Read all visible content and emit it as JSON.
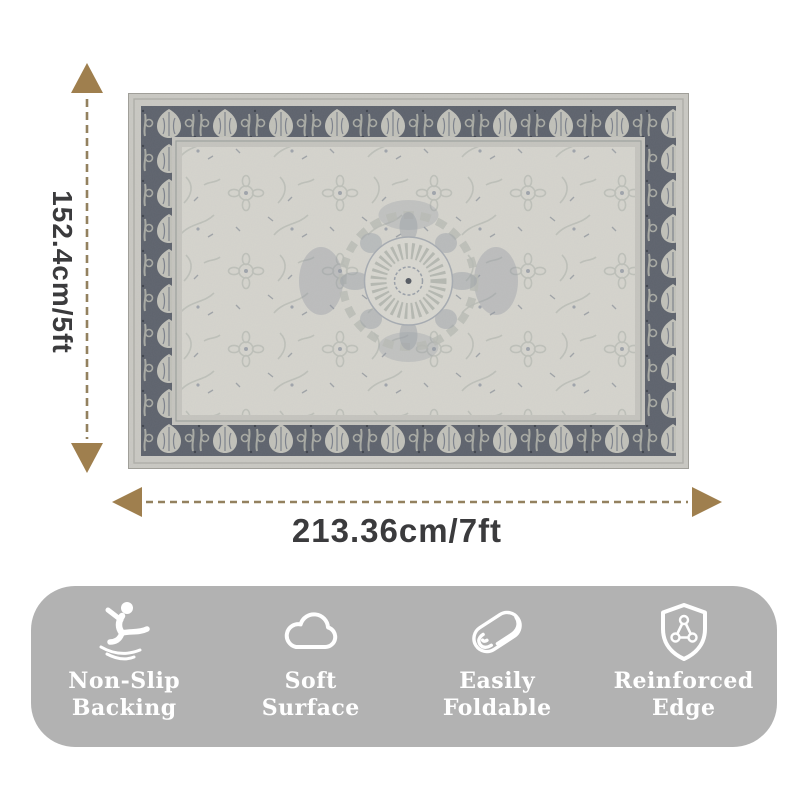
{
  "page": {
    "background_color": "#ffffff"
  },
  "rug": {
    "description": "vintage distressed oriental area rug, light gray field with dark gray floral border and center medallion",
    "field_color": "#d6d5ce",
    "border_color": "#5e636d",
    "leaf_color": "#c2c2ba"
  },
  "dimensions": {
    "height_label": "152.4cm/5ft",
    "width_label": "213.36cm/7ft",
    "arrowhead_color": "#9f7f4e",
    "dash_color": "#93815f",
    "text_color": "#3b3b3d"
  },
  "features": {
    "bar_color": "#b2b2b2",
    "text_color": "#ffffff",
    "items": [
      {
        "icon": "non-slip-backing-icon",
        "lines": [
          "Non-Slip",
          "Backing"
        ]
      },
      {
        "icon": "soft-surface-icon",
        "lines": [
          "Soft",
          "Surface"
        ]
      },
      {
        "icon": "easily-foldable-icon",
        "lines": [
          "Easily",
          "Foldable"
        ]
      },
      {
        "icon": "reinforced-edge-icon",
        "lines": [
          "Reinforced",
          "Edge"
        ]
      }
    ]
  }
}
